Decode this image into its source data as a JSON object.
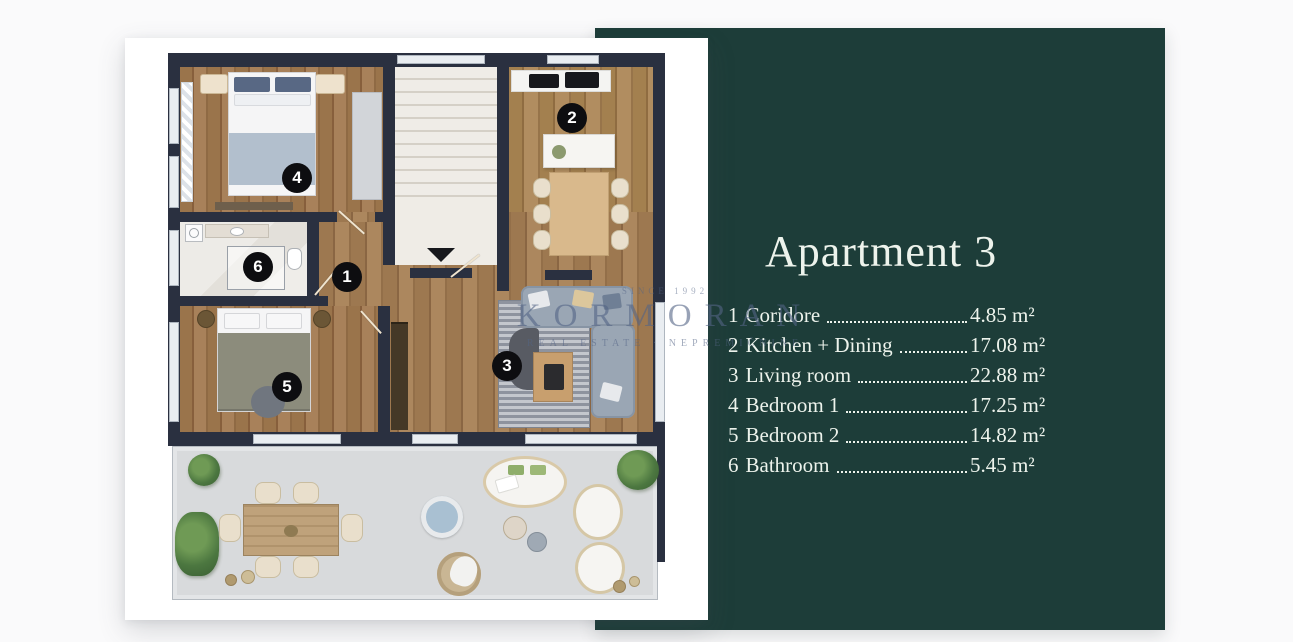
{
  "panel": {
    "title": "Apartment 3",
    "rooms": [
      {
        "num": "1",
        "name": "Coridore",
        "area": "4.85 m²"
      },
      {
        "num": "2",
        "name": "Kitchen + Dining",
        "area": "17.08 m²"
      },
      {
        "num": "3",
        "name": "Living room",
        "area": "22.88 m²"
      },
      {
        "num": "4",
        "name": "Bedroom 1",
        "area": "17.25 m²"
      },
      {
        "num": "5",
        "name": "Bedroom 2",
        "area": "14.82 m²"
      },
      {
        "num": "6",
        "name": "Bathroom",
        "area": "5.45 m²"
      }
    ]
  },
  "watermark": {
    "since": "SINCE 1992",
    "brand": "KORMORAN",
    "tagline": "REAL ESTATE · NEPREMIČNINE"
  },
  "colors": {
    "panel_green": "#1d3d39",
    "text_cream": "#edf3ec",
    "wall_navy": "#2a3040",
    "terrace_gray": "#d8dadc"
  }
}
